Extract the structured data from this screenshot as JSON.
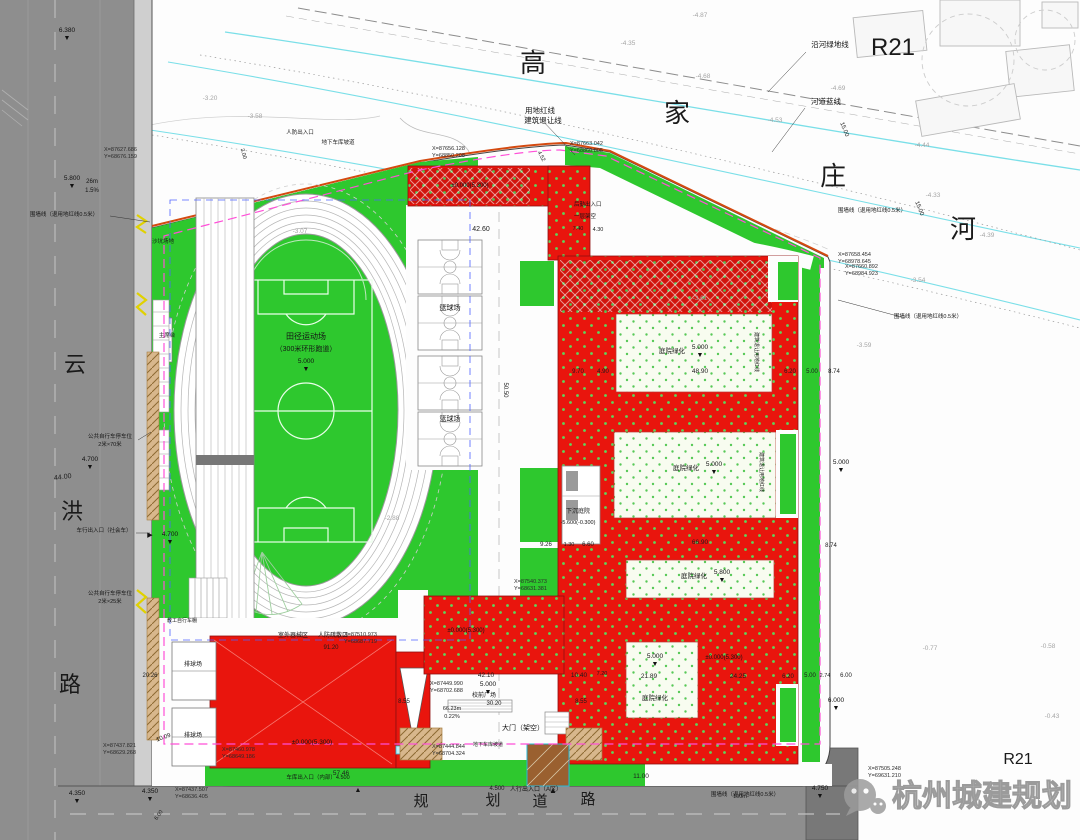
{
  "watermark": {
    "text": "杭州城建规划"
  },
  "zone_labels": {
    "top": "R21",
    "bottom": "R21"
  },
  "river": {
    "chars": [
      "高",
      "家",
      "庄",
      "河"
    ]
  },
  "west_road": {
    "chars": [
      "云",
      "洪",
      "路"
    ]
  },
  "south_road": {
    "chars": [
      "规",
      "划",
      "道",
      "路"
    ]
  },
  "colors": {
    "site_green": "#2ec82e",
    "building_red": "#e9150d",
    "river_cyan": "#7adfe8",
    "road_gray": "#8e8e8e",
    "boundary_magenta": "#ff4fd8",
    "boundary_blue": "#4f63ff",
    "boundary_orange": "#d44a10",
    "watermark_gray": "#9c9c9c"
  },
  "annotations": {
    "labels": [
      {
        "x": 540,
        "y": 113,
        "t": "用地红线",
        "s": 7.5,
        "n": "label-redline"
      },
      {
        "x": 543,
        "y": 123,
        "t": "建筑退让线",
        "s": 7.5,
        "n": "label-setback-line"
      },
      {
        "x": 830,
        "y": 47,
        "t": "沿河绿地线",
        "s": 7.5,
        "n": "label-river-green-line"
      },
      {
        "x": 826,
        "y": 104,
        "t": "河道蓝线",
        "s": 7.5,
        "n": "label-river-blue-line"
      },
      {
        "x": 64,
        "y": 216,
        "t": "围墙线（退用地红线0.5米）",
        "s": 5.5,
        "n": "label-fence-line"
      },
      {
        "x": 928,
        "y": 318,
        "t": "围墙线（退用地红线0.5米）",
        "s": 5.5,
        "n": "label-fence-line"
      },
      {
        "x": 872,
        "y": 212,
        "t": "围墙线（退用地红线0.5米）",
        "s": 5.5,
        "n": "label-fence-line"
      },
      {
        "x": 745,
        "y": 796,
        "t": "围墙线（退用地红线0.5米）",
        "s": 5.5,
        "n": "label-fence-line"
      },
      {
        "x": 110,
        "y": 438,
        "t": "公共自行车停车位",
        "s": 5.5
      },
      {
        "x": 110,
        "y": 446,
        "t": "2米×70米",
        "s": 5.5
      },
      {
        "x": 110,
        "y": 595,
        "t": "公共自行车停车位",
        "s": 5.5
      },
      {
        "x": 110,
        "y": 603,
        "t": "2米×25米",
        "s": 5.5
      },
      {
        "x": 104,
        "y": 532,
        "t": "车行出入口（社会车）",
        "s": 5.5
      },
      {
        "x": 150,
        "y": 537,
        "t": "▶",
        "s": 7
      },
      {
        "x": 306,
        "y": 339,
        "t": "田径运动场",
        "s": 8,
        "n": "label-athletics-field"
      },
      {
        "x": 306,
        "y": 351,
        "t": "（300米环形跑道）",
        "s": 7
      },
      {
        "x": 450,
        "y": 310,
        "t": "篮球场",
        "s": 7,
        "n": "label-basketball"
      },
      {
        "x": 450,
        "y": 421,
        "t": "篮球场",
        "s": 7,
        "n": "label-basketball"
      },
      {
        "x": 193,
        "y": 666,
        "t": "排球场",
        "s": 6,
        "n": "label-volleyball"
      },
      {
        "x": 193,
        "y": 737,
        "t": "排球场",
        "s": 6,
        "n": "label-volleyball"
      },
      {
        "x": 167,
        "y": 337,
        "t": "主席台",
        "s": 5.5,
        "n": "label-rostrum"
      },
      {
        "x": 163,
        "y": 243,
        "t": "沙坑场地",
        "s": 5.5,
        "n": "label-sandpit"
      },
      {
        "x": 293,
        "y": 637,
        "t": "室外器械区",
        "s": 6
      },
      {
        "x": 333,
        "y": 637,
        "t": "人防疏散口",
        "s": 6
      },
      {
        "x": 523,
        "y": 730,
        "t": "大门（架空）",
        "s": 7,
        "n": "label-main-gate"
      },
      {
        "x": 484,
        "y": 697,
        "t": "校前广场",
        "s": 6,
        "n": "label-front-plaza"
      },
      {
        "x": 578,
        "y": 513,
        "t": "下沉庭院",
        "s": 6,
        "n": "label-sunken-courtyard"
      },
      {
        "x": 578,
        "y": 524,
        "t": "-5.600(-0.300)",
        "s": 5.5
      },
      {
        "x": 312,
        "y": 744,
        "t": "±0.000(5.300)",
        "s": 6.5
      },
      {
        "x": 466,
        "y": 632,
        "t": "±0.000(5.300)",
        "s": 6
      },
      {
        "x": 724,
        "y": 659,
        "t": "±0.000(5.300)",
        "s": 6
      },
      {
        "x": 470,
        "y": 187,
        "t": "±0.000(5.300)",
        "s": 6
      },
      {
        "x": 574,
        "y": 206,
        "t": "后勤出入口",
        "s": 5.5,
        "anchor": "start"
      },
      {
        "x": 574,
        "y": 218,
        "t": "一层架空",
        "s": 5.5,
        "anchor": "start"
      },
      {
        "x": 300,
        "y": 134,
        "t": "人防出入口",
        "s": 5.5
      },
      {
        "x": 338,
        "y": 144,
        "t": "地下车库坡道",
        "s": 5.5
      },
      {
        "x": 488,
        "y": 746,
        "t": "地下车库坡道",
        "s": 5
      },
      {
        "x": 318,
        "y": 779,
        "t": "车库出入口（内部）4.500",
        "s": 5.5
      },
      {
        "x": 358,
        "y": 792,
        "t": "▲",
        "s": 7
      },
      {
        "x": 536,
        "y": 791,
        "t": "人行出入口（A区）",
        "s": 6
      },
      {
        "x": 553,
        "y": 793,
        "t": "▲",
        "s": 8
      },
      {
        "x": 182,
        "y": 622,
        "t": "教工自行车棚",
        "s": 5
      },
      {
        "x": 672,
        "y": 353,
        "t": "庭院绿化",
        "s": 6.5,
        "n": "label-courtyard-green"
      },
      {
        "x": 686,
        "y": 470,
        "t": "庭院绿化",
        "s": 6.5,
        "n": "label-courtyard-green"
      },
      {
        "x": 694,
        "y": 578,
        "t": "庭院绿化",
        "s": 6.5,
        "n": "label-courtyard-green"
      },
      {
        "x": 655,
        "y": 700,
        "t": "庭院绿化",
        "s": 6.5,
        "n": "label-courtyard-green"
      },
      {
        "x": 92,
        "y": 183,
        "t": "26m",
        "s": 6
      },
      {
        "x": 92,
        "y": 192,
        "t": "1.5%",
        "s": 6
      },
      {
        "x": 755,
        "y": 352,
        "t": "建筑退让用地红线",
        "s": 5,
        "rot": 90
      },
      {
        "x": 760,
        "y": 472,
        "t": "建筑退让用地红线",
        "s": 5,
        "rot": 90
      }
    ],
    "dims": [
      {
        "x": 63,
        "y": 479,
        "t": "44.00",
        "rot": -7
      },
      {
        "x": 481,
        "y": 231,
        "t": "42.60"
      },
      {
        "x": 578,
        "y": 230,
        "t": "7.40",
        "s": 5.5
      },
      {
        "x": 598,
        "y": 231,
        "t": "4.30",
        "s": 5.5
      },
      {
        "x": 540,
        "y": 157,
        "t": "4.52",
        "rot": 62,
        "s": 5.5
      },
      {
        "x": 843,
        "y": 130,
        "t": "15.00",
        "rot": 68,
        "s": 6
      },
      {
        "x": 918,
        "y": 209,
        "t": "15.00",
        "rot": 68,
        "s": 6
      },
      {
        "x": 242,
        "y": 154,
        "t": "3.00",
        "rot": 75,
        "s": 5.5
      },
      {
        "x": 578,
        "y": 373,
        "t": "9.70",
        "s": 6
      },
      {
        "x": 603,
        "y": 373,
        "t": "4.90",
        "s": 6
      },
      {
        "x": 700,
        "y": 373,
        "t": "48.90",
        "s": 6.5
      },
      {
        "x": 790,
        "y": 373,
        "t": "6.20",
        "s": 6
      },
      {
        "x": 812,
        "y": 373,
        "t": "5.00",
        "s": 6
      },
      {
        "x": 834,
        "y": 373,
        "t": "8.74",
        "s": 6
      },
      {
        "x": 504,
        "y": 390,
        "t": "50.50",
        "rot": 90,
        "s": 6
      },
      {
        "x": 700,
        "y": 544,
        "t": "66.90",
        "s": 6.5
      },
      {
        "x": 831,
        "y": 547,
        "t": "8.74",
        "s": 6
      },
      {
        "x": 546,
        "y": 546,
        "t": "9.26",
        "s": 6
      },
      {
        "x": 569,
        "y": 546,
        "t": "1.30",
        "s": 5.5
      },
      {
        "x": 588,
        "y": 546,
        "t": "6.60",
        "s": 6
      },
      {
        "x": 602,
        "y": 675,
        "t": "7.20",
        "s": 5.5
      },
      {
        "x": 649,
        "y": 678,
        "t": "21.89",
        "s": 6.5
      },
      {
        "x": 738,
        "y": 678,
        "t": "24.25",
        "s": 6.5
      },
      {
        "x": 788,
        "y": 678,
        "t": "6.20",
        "s": 6
      },
      {
        "x": 810,
        "y": 677,
        "t": "5.00",
        "s": 6
      },
      {
        "x": 825,
        "y": 677,
        "t": "2.74",
        "s": 5.5
      },
      {
        "x": 846,
        "y": 677,
        "t": "6.00",
        "s": 6
      },
      {
        "x": 486,
        "y": 677,
        "t": "42.10",
        "s": 6.5
      },
      {
        "x": 579,
        "y": 677,
        "t": "10.40",
        "s": 6.5
      },
      {
        "x": 404,
        "y": 703,
        "t": "8.55",
        "s": 6
      },
      {
        "x": 581,
        "y": 703,
        "t": "8.55",
        "s": 6
      },
      {
        "x": 494,
        "y": 705,
        "t": "30.20",
        "s": 6
      },
      {
        "x": 331,
        "y": 649,
        "t": "91.20",
        "s": 6
      },
      {
        "x": 150,
        "y": 677,
        "t": "20.26",
        "s": 6
      },
      {
        "x": 164,
        "y": 739,
        "t": "10.09",
        "rot": -20,
        "s": 6
      },
      {
        "x": 341,
        "y": 775,
        "t": "57.46",
        "s": 6.5
      },
      {
        "x": 641,
        "y": 778,
        "t": "11.00",
        "s": 6.5
      },
      {
        "x": 452,
        "y": 710,
        "t": "66.23m",
        "s": 5.5
      },
      {
        "x": 452,
        "y": 718,
        "t": "0.22%",
        "s": 5.5
      },
      {
        "x": 160,
        "y": 816,
        "t": "6.00",
        "rot": -55,
        "s": 5.5
      },
      {
        "x": 740,
        "y": 798,
        "t": "100m",
        "s": 5.5
      },
      {
        "x": 497,
        "y": 790,
        "t": "4.500",
        "s": 6
      }
    ],
    "elevs": [
      {
        "x": 67,
        "y": 32,
        "v": "6.380"
      },
      {
        "x": 72,
        "y": 180,
        "v": "5.800"
      },
      {
        "x": 90,
        "y": 461,
        "v": "4.700"
      },
      {
        "x": 170,
        "y": 536,
        "v": "4.700"
      },
      {
        "x": 77,
        "y": 795,
        "v": "4.350"
      },
      {
        "x": 150,
        "y": 793,
        "v": "4.350"
      },
      {
        "x": 820,
        "y": 790,
        "v": "4.750"
      },
      {
        "x": 836,
        "y": 702,
        "v": "6.000"
      },
      {
        "x": 841,
        "y": 464,
        "v": "5.000"
      },
      {
        "x": 306,
        "y": 363,
        "v": "5.000"
      },
      {
        "x": 488,
        "y": 686,
        "v": "5.000"
      },
      {
        "x": 700,
        "y": 349,
        "v": "5.000"
      },
      {
        "x": 714,
        "y": 466,
        "v": "5.000"
      },
      {
        "x": 722,
        "y": 574,
        "v": "5.800"
      },
      {
        "x": 655,
        "y": 658,
        "v": "5.000"
      }
    ],
    "coords": [
      {
        "x": 104,
        "y": 151,
        "l1": "X=87627.686",
        "l2": "Y=68676.159"
      },
      {
        "x": 432,
        "y": 150,
        "l1": "X=87656.128",
        "l2": "Y=68850.208"
      },
      {
        "x": 570,
        "y": 145,
        "l1": "X=87663.042",
        "l2": "Y=68860.805"
      },
      {
        "x": 838,
        "y": 256,
        "l1": "X=87658.454",
        "l2": "Y=68978.645"
      },
      {
        "x": 845,
        "y": 268,
        "l1": "X=87660.892",
        "l2": "Y=68984.923"
      },
      {
        "x": 344,
        "y": 636,
        "l1": "X=87510.973",
        "l2": "Y=68687.719"
      },
      {
        "x": 430,
        "y": 685,
        "l1": "X=87449.990",
        "l2": "Y=68702.688"
      },
      {
        "x": 432,
        "y": 748,
        "l1": "X=87444.844",
        "l2": "Y=68704.324"
      },
      {
        "x": 222,
        "y": 751,
        "l1": "X=87460.978",
        "l2": "Y=68649.186"
      },
      {
        "x": 103,
        "y": 747,
        "l1": "X=87437.821",
        "l2": "Y=68629.268"
      },
      {
        "x": 175,
        "y": 791,
        "l1": "X=87437.507",
        "l2": "Y=68636.405"
      },
      {
        "x": 868,
        "y": 770,
        "l1": "X=87505.248",
        "l2": "Y=69631.210"
      },
      {
        "x": 514,
        "y": 583,
        "l1": "X=87540.373",
        "l2": "Y=68631.381"
      }
    ],
    "survey": [
      {
        "x": 628,
        "y": 45,
        "t": "-4.35"
      },
      {
        "x": 703,
        "y": 78,
        "t": "-4.68"
      },
      {
        "x": 775,
        "y": 122,
        "t": "-4.53"
      },
      {
        "x": 838,
        "y": 90,
        "t": "-4.69"
      },
      {
        "x": 922,
        "y": 147,
        "t": "-4.44"
      },
      {
        "x": 933,
        "y": 197,
        "t": "-4.33"
      },
      {
        "x": 987,
        "y": 237,
        "t": "-4.39"
      },
      {
        "x": 918,
        "y": 282,
        "t": "-3.54"
      },
      {
        "x": 864,
        "y": 347,
        "t": "-3.59"
      },
      {
        "x": 210,
        "y": 100,
        "t": "-3.20"
      },
      {
        "x": 255,
        "y": 118,
        "t": "-3.58"
      },
      {
        "x": 700,
        "y": 17,
        "t": "-4.87"
      },
      {
        "x": 930,
        "y": 650,
        "t": "-0.77"
      },
      {
        "x": 1048,
        "y": 648,
        "t": "-0.58"
      },
      {
        "x": 1052,
        "y": 718,
        "t": "-0.43"
      },
      {
        "x": 392,
        "y": 520,
        "t": "-2.88"
      },
      {
        "x": 300,
        "y": 233,
        "t": "-3.07"
      },
      {
        "x": 700,
        "y": 300,
        "t": "-3.61"
      }
    ]
  }
}
